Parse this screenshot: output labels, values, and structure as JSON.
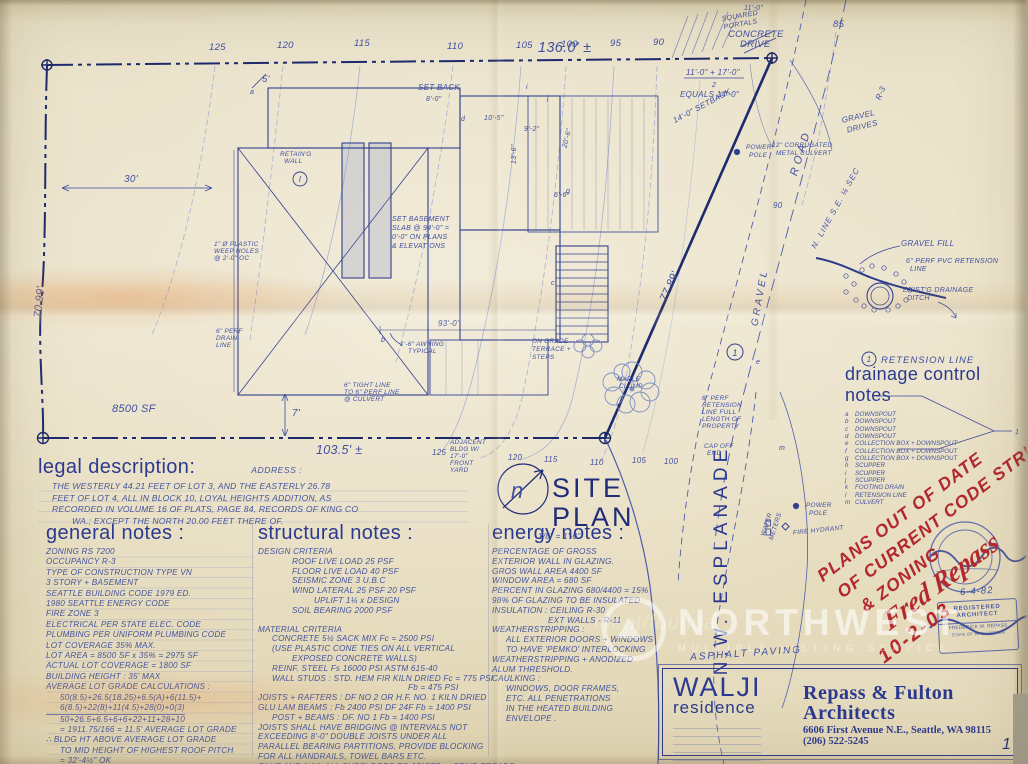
{
  "meta": {
    "page_number": "1"
  },
  "colors": {
    "ink": "#2b3990",
    "ink_light": "#7c8cc2",
    "red_stamp": "#b3282e",
    "paper": "#e8e0c8"
  },
  "title_block": {
    "project": "WALJI",
    "project_type": "residence",
    "firm_line1": "Repass & Fulton",
    "firm_line2": "Architects",
    "address": "6606 First Avenue N.E.,  Seattle, WA 98115",
    "phone": "(206) 522-5245"
  },
  "watermark": {
    "brand": "NORTHWEST",
    "tagline": "MULTIPLE LISTING SERVICE",
    "ghost": "ment/founda"
  },
  "stamps": {
    "date_handwritten": "6-4-82",
    "architect": {
      "line1": "REGISTERED",
      "line2": "ARCHITECT",
      "line3": "FREDERICK W. REPASS",
      "line4": "STATE OF WASHINGTON"
    }
  },
  "red_note": {
    "line1": "PLANS OUT OF DATE",
    "line2": "OF CURRENT CODE STRUCTURAL",
    "line3": "& ZONING",
    "signature": "Fred Repass",
    "date": "10-2-03"
  },
  "legal": {
    "heading": "legal description:",
    "address_label": "ADDRESS :",
    "lines": [
      "THE WESTERLY 44.21 FEET OF LOT 3, AND THE EASTERLY 26.78",
      "FEET OF LOT 4, ALL IN BLOCK 10, LOYAL HEIGHTS ADDITION, AS",
      "RECORDED IN VOLUME 16 OF PLATS, PAGE 84, RECORDS OF KING CO",
      "WA.;  EXCEPT THE NORTH 20.00 FEET THERE OF."
    ]
  },
  "general": {
    "heading": "general notes :",
    "lines": [
      "ZONING   RS 7200",
      "OCCUPANCY   R-3",
      "TYPE OF CONSTRUCTION   TYPE VN",
      "3 STORY + BASEMENT",
      "SEATTLE BUILDING CODE 1979 ED.",
      "1980 SEATTLE ENERGY CODE",
      "FIRE ZONE 3",
      "ELECTRICAL PER STATE ELEC. CODE",
      "PLUMBING PER UNIFORM PLUMBING CODE",
      "LOT COVERAGE   35%  MAX.",
      "LOT AREA = 8500 SF x 35% = 2975 SF",
      "ACTUAL LOT COVERAGE = 1800 SF",
      "BUILDING HEIGHT : 35' MAX",
      "AVERAGE LOT GRADE CALCULATIONS :",
      "50(8.5)+26.5(18.25)+6.5(A)+6(11.5)+",
      "6(8.5)+22(8)+11(4.5)+28(0)+0(3)",
      "50+26.5+6.5+6+6+22+11+28+10",
      "= 1911.75/166  =  11.5' AVERAGE LOT GRADE",
      "∴ BLDG HT ABOVE AVERAGE LOT GRADE",
      "TO MID HEIGHT OF HIGHEST ROOF PITCH",
      "= 32'-4½\"   OK"
    ]
  },
  "structural": {
    "heading": "structural notes :",
    "lines": [
      "DESIGN CRITERIA",
      "ROOF LIVE LOAD   25 PSF",
      "FLOOR LIVE LOAD   40 PSF",
      "SEISMIC ZONE 3   U.B.C",
      "WIND LATERAL   25 PSF   20 PSF",
      "UPLIFT   1¼ x DESIGN",
      "SOIL BEARING   2000 PSF",
      "MATERIAL CRITERIA",
      "CONCRETE 5½ SACK MIX   Fc = 2500 PSI",
      "(USE PLASTIC CONE TIES ON ALL VERTICAL",
      "EXPOSED CONCRETE WALLS)",
      "REINF. STEEL   Fs  16000 PSI  ASTM 615-40",
      "WALL STUDS : STD. HEM FIR  KILN DRIED  Fc = 775 PSI",
      "Fb = 475 PSI",
      "JOISTS + RAFTERS :  DF NO 2 OR H.F. NO. 1  KILN DRIED",
      "GLU LAM BEAMS :  Fb 2400 PSI   DF 24F    Fb = 1400 PSI",
      "POST + BEAMS :  DF. NO 1   Fb = 1400 PSI",
      "JOISTS SHALL HAVE BRIDGING @ INTERVALS NOT",
      "EXCEEDING 8'-0\"  DOUBLE JOISTS UNDER ALL",
      "PARALLEL BEARING PARTITIONS, PROVIDE BLOCKING",
      "FOR ALL HANDRAILS, TOWEL BARS ETC.",
      "GLUE AND NAIL ALL SUBFLOORS TO JOISTS, + STAIR TREADS"
    ]
  },
  "energy": {
    "heading": "energy notes :",
    "lines": [
      "PERCENTAGE OF GROSS",
      "EXTERIOR WALL IN GLAZING.",
      "GROS WALL AREA   4400 SF",
      "WINDOW AREA  =  680 SF",
      "PERCENT IN GLAZING  680/4400 = 15%",
      "98% OF GLAZING TO BE INSULATED",
      "INSULATION :  CEILING  R-30",
      "EXT WALLS - R-11",
      "WEATHERSTRIPPING :",
      "ALL EXTERIOR DOORS + WINDOWS",
      "TO HAVE 'PEMKO' INTERLOCKING",
      "WEATHERSTRIPPING + ANODIZED",
      "ALUM THRESHOLD.",
      "CAULKING :",
      "WINDOWS, DOOR FRAMES,",
      "ETC. ALL PENETRATIONS",
      "IN THE HEATED BUILDING",
      "ENVELOPE ."
    ]
  },
  "drainage": {
    "heading": "drainage control notes",
    "legend_ref": "1",
    "legend_label": "RETENSION LINE",
    "bracket_ref": "1",
    "items": [
      {
        "k": "a",
        "v": "DOWNSPOUT"
      },
      {
        "k": "b",
        "v": "DOWNSPOUT"
      },
      {
        "k": "c",
        "v": "DOWNSPOUT"
      },
      {
        "k": "d",
        "v": "DOWNSPOUT"
      },
      {
        "k": "e",
        "v": "COLLECTION BOX + DOWNSPOUT"
      },
      {
        "k": "f",
        "v": "COLLECTION BOX + DOWNSPOUT"
      },
      {
        "k": "g",
        "v": "COLLECTION BOX + DOWNSPOUT"
      },
      {
        "k": "h",
        "v": "SCUPPER"
      },
      {
        "k": "i",
        "v": "SCUPPER"
      },
      {
        "k": "j",
        "v": "SCUPPER"
      },
      {
        "k": "k",
        "v": "FOOTING DRAIN"
      },
      {
        "k": "l",
        "v": "RETENSION LINE"
      },
      {
        "k": "m",
        "v": "CULVERT"
      }
    ]
  },
  "plan": {
    "title1": "SITE",
    "title2": "PLAN",
    "scale": "1/8\" = 1'-0\"",
    "refs": {
      "north": "n",
      "plan_marker": "1",
      "legend_marker": "1",
      "wall_ref": "I"
    },
    "contours_top": [
      "125",
      "120",
      "115",
      "110",
      "105",
      "100",
      "95",
      "90"
    ],
    "contour_85": "85",
    "contours_bottom": [
      "125",
      "120",
      "115",
      "110",
      "105",
      "100"
    ],
    "contour_90": "90",
    "dims": {
      "frontage": "136.0' ±",
      "west": "70.99'",
      "south": "103.5' ±",
      "east": "77.89'",
      "d30": "30'",
      "d7": "7'",
      "d5": "5'",
      "d93": "93'-0\"",
      "area": "8500 SF",
      "eq_top": "11'-0\" + 17'-0\"",
      "eq_den": "2",
      "eq_result": "EQUALS 14'-0\"",
      "setback14": "14'-0\" SETBACK",
      "portal_dim": "11'-0\"",
      "b1": "10'-5\"",
      "b2": "9'-2\"",
      "b3": "13'-6\"",
      "b4": "20'-6\"",
      "b5": "6'-6\"",
      "sb8": "8'-0\""
    },
    "labels": {
      "concrete1": "CONCRETE",
      "concrete2": "DRIVE",
      "gravel_drives1": "GRAVEL",
      "gravel_drives2": "DRIVES",
      "r3": "R-3",
      "road": "ROAD",
      "gravel": "GRAVEL",
      "nline": "N. LINE  S.E. ¼  SEC",
      "culvert1": "12\" CORRUGATED",
      "culvert2": "METAL CULVERT",
      "power1": "POWER",
      "power2": "POLE",
      "gravel_fill": "GRAVEL FILL",
      "pvc1": "6\" PERF PVC RETENSION",
      "pvc2": "LINE",
      "ditch1": "EXIST'G DRAINAGE",
      "ditch2": "DITCH",
      "esplanade": "N.W.  ESPLANADE",
      "asphalt": "ASPHALT  PAVING",
      "water1": "WATER",
      "water2": "METERS",
      "hydrant": "FIRE HYDRANT",
      "full1": "6\" PERF",
      "full2": "RETENSION",
      "full3": "LINE FULL",
      "full4": "LENGTH OF",
      "full5": "PROPERTY",
      "cap1": "CAP OFF",
      "cap2": "END",
      "weep1": "1\" Ø PLASTIC",
      "weep2": "WEEP HOLES",
      "weep3": "@ 2'-0\" OC",
      "drain1": "6\" PERF",
      "drain2": "DRAIN",
      "drain3": "LINE",
      "ret1": "RETAIN'G",
      "ret2": "WALL",
      "bsmt1": "SET BASEMENT",
      "bsmt2": "SLAB @ 94'-0\" =",
      "bsmt3": "0'-0\" ON PLANS",
      "bsmt4": "& ELEVATIONS",
      "terr1": "ON GRADE",
      "terr2": "TERRACE +",
      "terr3": "STEPS",
      "awn1": "1'-6\" AWNING",
      "awn2": "TYPICAL",
      "maple1": "MAPLE",
      "maple2": "CLUMP",
      "adj1": "ADJACENT",
      "adj2": "BLDG W/",
      "adj3": "17'-0\"",
      "adj4": "FRONT",
      "adj5": "YARD",
      "tight1": "6\" TIGHT LINE",
      "tight2": "TO 6\" PERF LINE",
      "tight3": "@ CULVERT",
      "setback": "SET BACK",
      "portals1": "SQUARED",
      "portals2": "PORTALS"
    },
    "marker_letters": {
      "a": "a",
      "b": "b",
      "c": "c",
      "d": "d",
      "e": "e",
      "g": "g",
      "i": "i",
      "j": "j",
      "m": "m"
    }
  }
}
